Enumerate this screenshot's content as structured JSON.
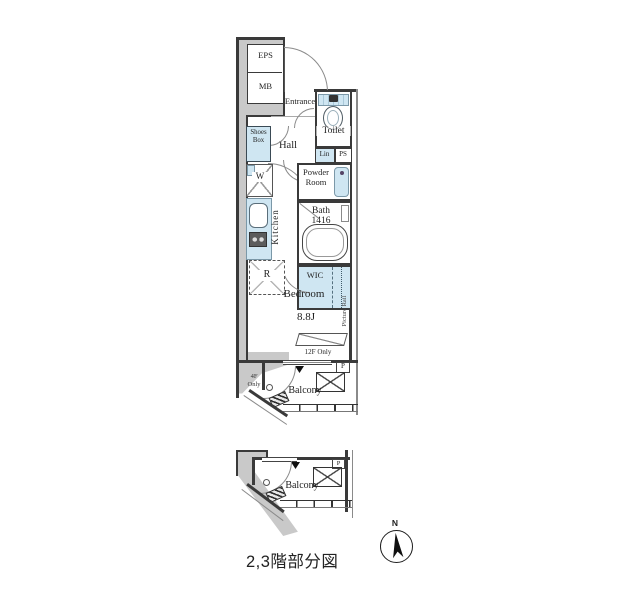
{
  "meta": {
    "caption": "2,3階部分図",
    "compass_north": "N"
  },
  "colors": {
    "common_area_gray": "#c9c9c9",
    "fixture_blue": "#cfe6f2",
    "wall_dark": "#3a3a3a"
  },
  "labels": {
    "eps": "EPS",
    "mb": "MB",
    "entrance": "Entrance",
    "toilet": "Toilet",
    "lin": "Lin",
    "ps": "PS",
    "shoes1": "Shoes",
    "shoes2": "Box",
    "hall": "Hall",
    "washer": "W",
    "powder1": "Powder",
    "powder2": "Room",
    "bath": "Bath",
    "bath_size": "1416",
    "kitchen": "Kitchen",
    "fridge": "R",
    "wic": "WIC",
    "bedroom": "Bedroom",
    "bedroom_size": "8.8J",
    "picture_rail": "Picture Rail",
    "only12f": "12F Only",
    "p1": "P",
    "balcony1": "Balcony",
    "only4f1": "4F",
    "only4f2": "Only",
    "balcony2": "Balcony",
    "p2": "P"
  }
}
